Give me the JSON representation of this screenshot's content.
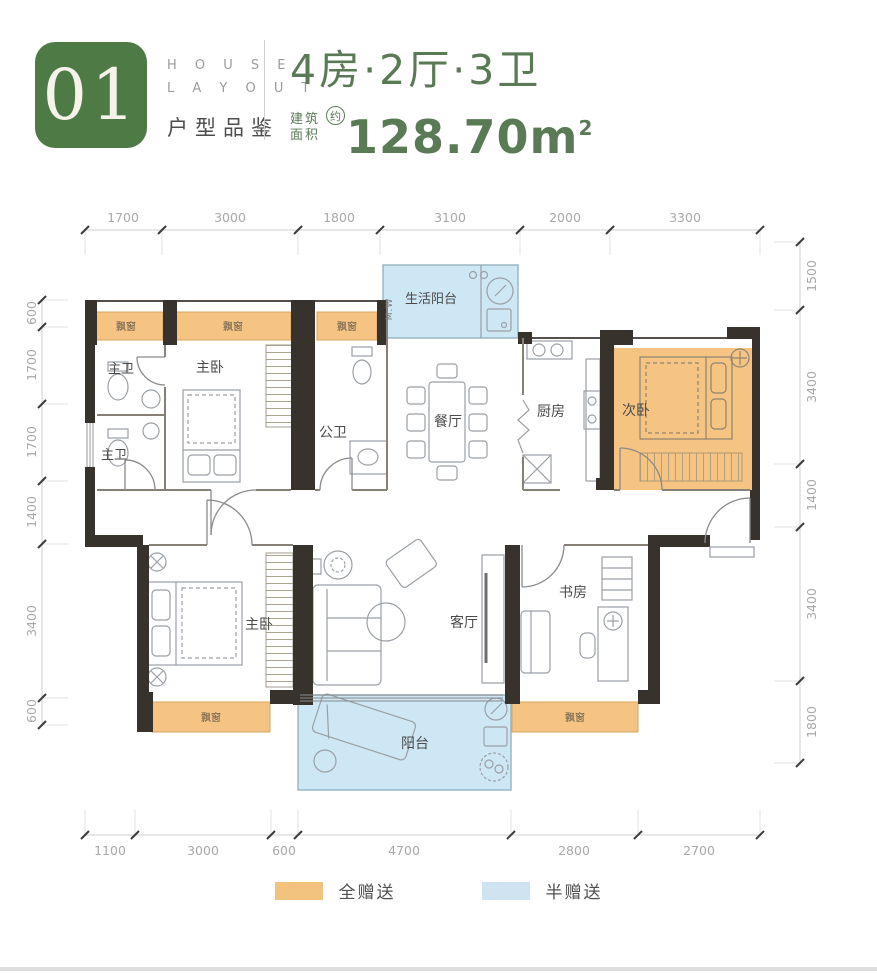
{
  "header": {
    "unit_number": "01",
    "house_word": "H O U S E",
    "layout_word": "L A Y O U T",
    "subtitle": "户型品鉴",
    "title": "4房·2厅·3卫",
    "area_prefix_line1": "建筑",
    "area_prefix_line2": "面积",
    "area_approx": "约",
    "area_value": "128.70",
    "area_unit": "m",
    "area_exponent": "2",
    "accent_green": "#4e7b45"
  },
  "plan": {
    "rooms": {
      "service_balcony": "生活阳台",
      "master_bath_upper": "主卫",
      "master_bath_lower": "主卫",
      "master_bedroom_top": "主卧",
      "public_bath": "公卫",
      "dining_room": "餐厅",
      "kitchen": "厨房",
      "second_bedroom": "次卧",
      "master_bedroom_bottom": "主卧",
      "living_room": "客厅",
      "study": "书房",
      "balcony": "阳台"
    },
    "labels": {
      "bay_window": "飘窗",
      "washing_machine": "M.W"
    },
    "dims_top": [
      "1700",
      "3000",
      "1800",
      "3100",
      "2000",
      "3300"
    ],
    "dims_left": [
      "600",
      "1700",
      "1700",
      "1400",
      "3400",
      "600"
    ],
    "dims_right": [
      "1500",
      "3400",
      "1400",
      "3400",
      "1800"
    ],
    "dims_bottom": [
      "1100",
      "3000",
      "600",
      "4700",
      "2800",
      "2700"
    ],
    "colors": {
      "full_gift_fill": "#f5c483",
      "half_gift_fill": "#cde7f4",
      "wall": "#38322d"
    }
  },
  "legend": {
    "full_gift_label": "全赠送",
    "half_gift_label": "半赠送"
  }
}
